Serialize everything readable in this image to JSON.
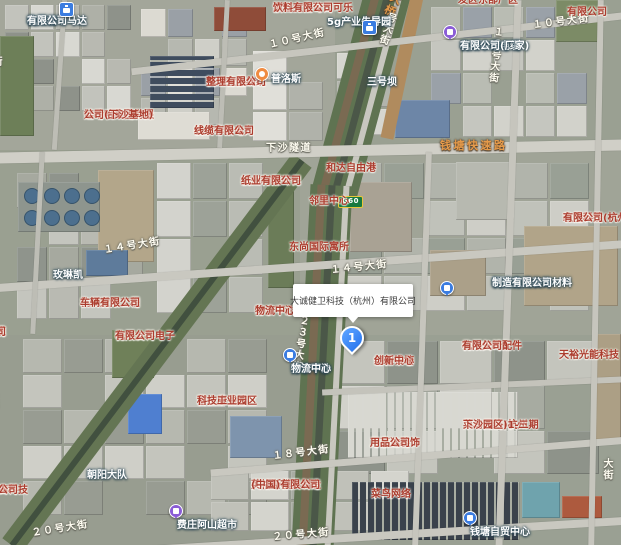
{
  "infobox": {
    "title": "大诚健卫科技（杭州）有限公司"
  },
  "marker": {
    "label": "1"
  },
  "highway_shield": {
    "label": "G60"
  },
  "colors": {
    "company_label": "#ab3c2e",
    "poi_label": "#ffffff",
    "road_label": "#fffdf2",
    "expressway_label": "#e59a4a",
    "marker_blue": "#3f8cff",
    "icon_blue": "#3b7ce0",
    "icon_purple": "#8a5cd6",
    "icon_orange": "#ef8b41",
    "shield_green": "#17793f"
  },
  "labels": [
    {
      "name": "label-panasonic-motor",
      "kind": "poi",
      "lines": [
        "杭州松下马达",
        "有限公司"
      ],
      "x": 27,
      "y": 16,
      "clickable": true,
      "icon": {
        "type": "briefcase-blue",
        "x": 59,
        "y": 2
      }
    },
    {
      "name": "label-5g-industrial-park",
      "kind": "poi",
      "lines": [
        "5g产业先导园"
      ],
      "x": 327,
      "y": 17,
      "clickable": true,
      "icon": {
        "type": "briefcase-blue",
        "x": 362,
        "y": 20
      }
    },
    {
      "name": "label-taikoo-cocacola",
      "kind": "company",
      "lines": [
        "浙江太古可口可乐",
        "饮料有限公司"
      ],
      "x": 273,
      "y": 3,
      "clickable": true
    },
    {
      "name": "label-fadong-east-plant",
      "kind": "company",
      "lines": [
        "发区东部厂区"
      ],
      "x": 458,
      "y": -5,
      "clickable": true
    },
    {
      "name": "label-topright-company",
      "kind": "company",
      "lines": [
        "有限公司"
      ],
      "x": 567,
      "y": 7,
      "clickable": true
    },
    {
      "name": "label-road-10th-ave-west",
      "kind": "roadlbl",
      "lines": [
        "１０号大街"
      ],
      "x": 268,
      "y": 40,
      "rot": -13,
      "clickable": false
    },
    {
      "name": "label-road-10th-ave-east",
      "kind": "roadlbl",
      "lines": [
        "１０号大街"
      ],
      "x": 532,
      "y": 20,
      "rot": -7,
      "clickable": false
    },
    {
      "name": "label-road-19th-ave",
      "kind": "roadlbl",
      "lines": [
        "１９号大街"
      ],
      "x": 503,
      "y": 27,
      "vertical": true,
      "rot": 6,
      "clickable": false
    },
    {
      "name": "label-road-bridge",
      "kind": "road-orange",
      "lines": [
        "大桥"
      ],
      "x": 404,
      "y": -4,
      "vertical": true,
      "rot": 26,
      "clickable": false
    },
    {
      "name": "label-road-bridge-street",
      "kind": "roadlbl",
      "lines": [
        "号大街"
      ],
      "x": 397,
      "y": 14,
      "vertical": true,
      "rot": 18,
      "clickable": false
    },
    {
      "name": "label-road-partial-left-top",
      "kind": "roadlbl",
      "lines": [
        "街"
      ],
      "x": 1,
      "y": 56,
      "vertical": true,
      "clickable": false
    },
    {
      "name": "label-jinjing-textile",
      "kind": "company",
      "lines": [
        "杭州金晶纺织",
        "整理有限公司"
      ],
      "x": 206,
      "y": 77,
      "clickable": true
    },
    {
      "name": "label-sanhaoba",
      "kind": "poi",
      "lines": [
        "三号坝"
      ],
      "x": 367,
      "y": 77,
      "clickable": true
    },
    {
      "name": "label-zhongce-cable",
      "kind": "poi",
      "lines": [
        "杭州中策电缆",
        "有限公司(厂家)"
      ],
      "x": 460,
      "y": 41,
      "clickable": true,
      "icon": {
        "type": "circle-purple",
        "x": 443,
        "y": 25
      }
    },
    {
      "name": "label-glp",
      "kind": "poi",
      "lines": [
        "普洛斯"
      ],
      "x": 271,
      "y": 74,
      "align": "left",
      "clickable": true,
      "icon": {
        "type": "pin-orange",
        "x": 255,
        "y": 67
      }
    },
    {
      "name": "label-wahaha",
      "kind": "company",
      "lines": [
        "娃哈哈集团有限",
        "公司(下沙基地)"
      ],
      "x": 84,
      "y": 110,
      "clickable": true
    },
    {
      "name": "label-huaxin-cable",
      "kind": "company",
      "lines": [
        "杭州华新电力",
        "线缆有限公司"
      ],
      "x": 194,
      "y": 126,
      "clickable": true
    },
    {
      "name": "label-road-xiasha-tunnel",
      "kind": "roadlbl",
      "lines": [
        "下沙隧道"
      ],
      "x": 266,
      "y": 143,
      "clickable": false
    },
    {
      "name": "label-road-qiantang-expwy",
      "kind": "road-orange",
      "lines": [
        "钱塘快速路"
      ],
      "x": 440,
      "y": 139,
      "clickable": false
    },
    {
      "name": "label-road-partial-left-2",
      "kind": "roadlbl",
      "lines": [
        "号大街"
      ],
      "x": -3,
      "y": 148,
      "vertical": true,
      "rot": 6,
      "clickable": false
    },
    {
      "name": "label-heda-freeport",
      "kind": "company",
      "lines": [
        "和达自由港"
      ],
      "x": 326,
      "y": 163,
      "clickable": true
    },
    {
      "name": "label-liqun-paper",
      "kind": "company",
      "lines": [
        "杭州利群环保",
        "纸业有限公司"
      ],
      "x": 241,
      "y": 176,
      "clickable": true
    },
    {
      "name": "label-linli-center",
      "kind": "company",
      "lines": [
        "邻里中心"
      ],
      "x": 309,
      "y": 196,
      "clickable": true
    },
    {
      "name": "label-jiuneng-tech",
      "kind": "company",
      "lines": [
        "玖能科技(杭州)",
        "有限公司"
      ],
      "x": 563,
      "y": 213,
      "clickable": true
    },
    {
      "name": "label-dongshang-intl",
      "kind": "company",
      "lines": [
        "东尚国际寓所"
      ],
      "x": 289,
      "y": 242,
      "clickable": true
    },
    {
      "name": "label-road-14th-ave-west",
      "kind": "roadlbl",
      "lines": [
        "１４号大街"
      ],
      "x": 103,
      "y": 245,
      "rot": -9,
      "clickable": false
    },
    {
      "name": "label-road-14th-ave",
      "kind": "roadlbl",
      "lines": [
        "１４号大街"
      ],
      "x": 330,
      "y": 265,
      "rot": -6,
      "clickable": false
    },
    {
      "name": "label-meilinkai",
      "kind": "poi",
      "lines": [
        "玫琳凯"
      ],
      "x": 53,
      "y": 270,
      "clickable": true
    },
    {
      "name": "label-aichi-engineering",
      "kind": "company",
      "lines": [
        "杭州爱知工程",
        "车辆有限公司"
      ],
      "x": 80,
      "y": 298,
      "clickable": true
    },
    {
      "name": "label-partial-cable-co",
      "kind": "company",
      "lines": [
        "线缆",
        "公司"
      ],
      "x": -14,
      "y": 327,
      "align": "left",
      "clickable": true
    },
    {
      "name": "label-suning-red",
      "kind": "company",
      "lines": [
        "苏宁下沙",
        "物流中心"
      ],
      "x": 255,
      "y": 306,
      "clickable": true
    },
    {
      "name": "label-youke-electronics",
      "kind": "company",
      "lines": [
        "杭州友科电子",
        "有限公司"
      ],
      "x": 115,
      "y": 331,
      "clickable": true
    },
    {
      "name": "label-suning-poi",
      "kind": "poi",
      "lines": [
        "苏宁下沙",
        "物流中心"
      ],
      "x": 291,
      "y": 364,
      "clickable": true,
      "icon": {
        "type": "circle-blue",
        "x": 283,
        "y": 348
      }
    },
    {
      "name": "label-mengshi-decoration",
      "kind": "poi",
      "lines": [
        "杭州孟氏装饰材料",
        "制造有限公司"
      ],
      "x": 492,
      "y": 278,
      "clickable": true,
      "icon": {
        "type": "circle-blue",
        "x": 440,
        "y": 281
      }
    },
    {
      "name": "label-zongbao-innovation",
      "kind": "company",
      "lines": [
        "综保钱塘",
        "创新中心"
      ],
      "x": 374,
      "y": 356,
      "clickable": true
    },
    {
      "name": "label-yazaki-parts",
      "kind": "company",
      "lines": [
        "杭州矢崎配件",
        "有限公司"
      ],
      "x": 462,
      "y": 341,
      "clickable": true
    },
    {
      "name": "label-tianyu-solar",
      "kind": "company",
      "lines": [
        "天裕光能科技"
      ],
      "x": 559,
      "y": 350,
      "clickable": true
    },
    {
      "name": "label-road-23rd-ave",
      "kind": "roadlbl",
      "lines": [
        "２３号大街"
      ],
      "x": 309,
      "y": 316,
      "vertical": true,
      "rot": 9,
      "clickable": false
    },
    {
      "name": "label-foxconn-park",
      "kind": "company",
      "lines": [
        "富士康钱塘",
        "科技工业园区"
      ],
      "x": 197,
      "y": 396,
      "clickable": true
    },
    {
      "name": "label-cainiao-park",
      "kind": "company",
      "lines": [
        "菜鸟网络(杭州",
        "下沙园区)1-二期"
      ],
      "x": 463,
      "y": 420,
      "clickable": true
    },
    {
      "name": "label-wanshida",
      "kind": "company",
      "lines": [
        "万事达装饰",
        "用品公司"
      ],
      "x": 370,
      "y": 438,
      "clickable": true
    },
    {
      "name": "label-road-18th-ave",
      "kind": "roadlbl",
      "lines": [
        "１８号大街"
      ],
      "x": 272,
      "y": 451,
      "rot": -7,
      "clickable": false
    },
    {
      "name": "label-chaoyang-brigade",
      "kind": "poi",
      "lines": [
        "朝阳大队"
      ],
      "x": 87,
      "y": 470,
      "clickable": true
    },
    {
      "name": "label-partial-baogao",
      "kind": "company",
      "lines": [
        "保高科技",
        "限公司"
      ],
      "x": -12,
      "y": 485,
      "align": "left",
      "clickable": true
    },
    {
      "name": "label-ingersoll-mould",
      "kind": "company",
      "lines": [
        "英格斯模具制造",
        "(中国)有限公司"
      ],
      "x": 251,
      "y": 480,
      "clickable": true
    },
    {
      "name": "label-cainiao-network",
      "kind": "company",
      "lines": [
        "菜鸟网络"
      ],
      "x": 371,
      "y": 489,
      "clickable": true
    },
    {
      "name": "label-feizhuang-market",
      "kind": "poi",
      "lines": [
        "费庄阿山超市"
      ],
      "x": 177,
      "y": 520,
      "clickable": true,
      "icon": {
        "type": "circle-purple",
        "x": 169,
        "y": 504
      }
    },
    {
      "name": "label-road-20th-ave-west",
      "kind": "roadlbl",
      "lines": [
        "２０号大街"
      ],
      "x": 31,
      "y": 528,
      "rot": -9,
      "clickable": false
    },
    {
      "name": "label-road-20th-ave-east",
      "kind": "roadlbl",
      "lines": [
        "２０号大街"
      ],
      "x": 272,
      "y": 532,
      "rot": -5,
      "clickable": false
    },
    {
      "name": "label-qiantang-ftz",
      "kind": "poi",
      "lines": [
        "钱塘自贸中心"
      ],
      "x": 470,
      "y": 527,
      "clickable": true,
      "icon": {
        "type": "circle-blue",
        "x": 463,
        "y": 511
      }
    },
    {
      "name": "label-road-partial-left-3",
      "kind": "roadlbl",
      "lines": [
        "大街"
      ],
      "x": -3,
      "y": 392,
      "vertical": true,
      "clickable": false
    },
    {
      "name": "label-road-partial-right",
      "kind": "roadlbl",
      "lines": [
        "大街"
      ],
      "x": 612,
      "y": 458,
      "vertical": true,
      "clickable": false
    }
  ]
}
